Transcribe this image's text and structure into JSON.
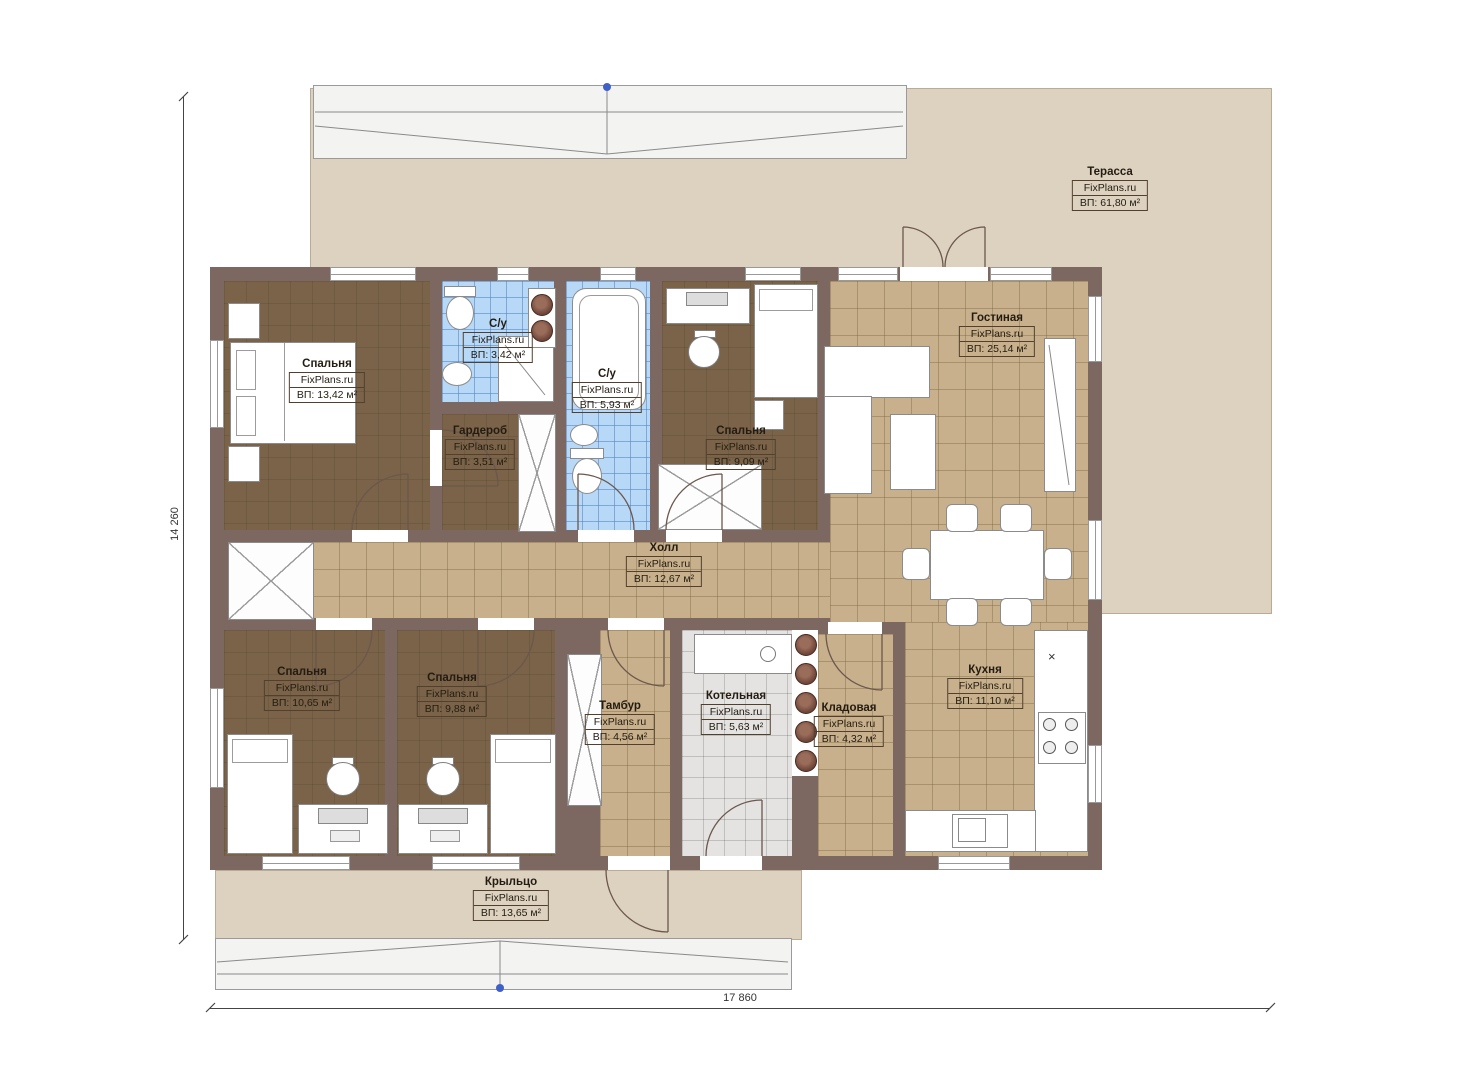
{
  "watermark": "FixPlans.ru",
  "dimensions": {
    "width": "17 860",
    "height": "14 260"
  },
  "rooms": [
    {
      "name": "Терасса",
      "area": "ВП: 61,80 м²"
    },
    {
      "name": "Гостиная",
      "area": "ВП: 25,14 м²"
    },
    {
      "name": "Спальня",
      "area": "ВП: 13,42 м²"
    },
    {
      "name": "С/у",
      "area": "ВП: 3,42 м²"
    },
    {
      "name": "С/у",
      "area": "ВП: 5,93 м²"
    },
    {
      "name": "Гардероб",
      "area": "ВП: 3,51 м²"
    },
    {
      "name": "Спальня",
      "area": "ВП: 9,09 м²"
    },
    {
      "name": "Холл",
      "area": "ВП: 12,67 м²"
    },
    {
      "name": "Спальня",
      "area": "ВП: 10,65 м²"
    },
    {
      "name": "Спальня",
      "area": "ВП: 9,88 м²"
    },
    {
      "name": "Тамбур",
      "area": "ВП: 4,56 м²"
    },
    {
      "name": "Котельная",
      "area": "ВП: 5,63 м²"
    },
    {
      "name": "Кладовая",
      "area": "ВП: 4,32 м²"
    },
    {
      "name": "Кухня",
      "area": "ВП: 11,10 м²"
    },
    {
      "name": "Крыльцо",
      "area": "ВП: 13,65 м²"
    }
  ],
  "misc": {
    "kitchen_x_mark": "×"
  },
  "colors": {
    "wall": "#7c6860",
    "floor_tile_tan": "#c7b08b",
    "floor_carpet_brown": "#7a6348",
    "floor_bathroom_blue": "#b7d8f6",
    "floor_boiler_gray": "#e4e3e1",
    "terrace_beige": "#ddd1bf",
    "marker_blue": "#3f5fc9"
  }
}
